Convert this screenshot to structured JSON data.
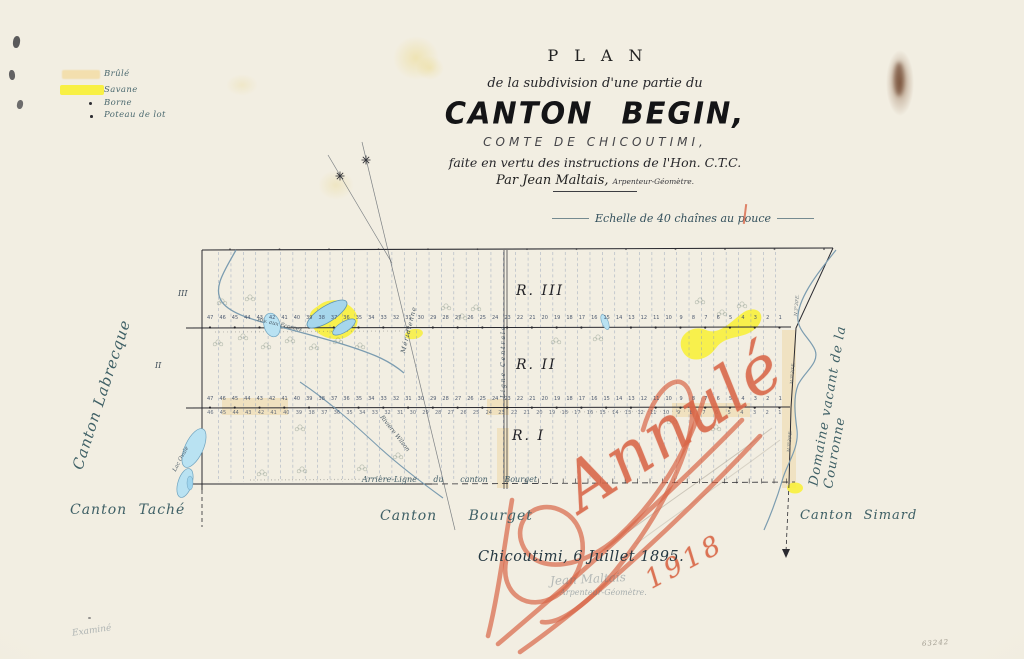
{
  "legend": {
    "items": [
      {
        "label": "Brûlé",
        "swatch": "tan"
      },
      {
        "label": "Savane",
        "swatch": "yellow"
      },
      {
        "label": "Borne",
        "swatch": "dot"
      },
      {
        "label": "Poteau de lot",
        "swatch": "dot"
      }
    ]
  },
  "title": {
    "kicker": "PLAN",
    "line1": "de la subdivision d'une partie du",
    "main": "CANTON BEGIN,",
    "subtitle": "COMTE DE CHICOUTIMI,",
    "line2": "faite en vertu des instructions de l'Hon. C.T.C.",
    "byline": "Par Jean Maltais,",
    "byline_role": "Arpenteur-Géomètre.",
    "scale": "Echelle de 40 chaînes au pouce"
  },
  "map": {
    "range_labels": [
      "R. III",
      "R. II",
      "R. I"
    ],
    "margin_numerals": [
      "III",
      "II"
    ],
    "central_line_label": "Ligne Centrale",
    "meridian_label": "Méridienne",
    "labels": {
      "river_left": "Riv. aux Écorces",
      "river_wilson": "Rivière Wilson",
      "lake_left": "Lac Ovale",
      "bearing": "N.3°30'E.",
      "arriere_ligne": "Arrière-Ligne  du canton  Bourget"
    },
    "lot_rows": [
      {
        "id": "lots-r3",
        "numbers": [
          47,
          46,
          45,
          44,
          43,
          42,
          41,
          40,
          39,
          38,
          37,
          36,
          35,
          34,
          33,
          32,
          31,
          30,
          29,
          28,
          27,
          26,
          25,
          24,
          23,
          22,
          21,
          20,
          19,
          18,
          17,
          16,
          15,
          14,
          13,
          12,
          11,
          10,
          9,
          8,
          7,
          6,
          5,
          4,
          3,
          2,
          1
        ]
      },
      {
        "id": "lots-r2",
        "numbers": [
          47,
          46,
          45,
          44,
          43,
          42,
          41,
          40,
          39,
          38,
          37,
          36,
          35,
          34,
          33,
          32,
          31,
          30,
          29,
          28,
          27,
          26,
          25,
          24,
          23,
          22,
          21,
          20,
          19,
          18,
          17,
          16,
          15,
          14,
          13,
          12,
          11,
          10,
          9,
          8,
          7,
          6,
          5,
          4,
          3,
          2,
          1
        ]
      },
      {
        "id": "lots-r1",
        "numbers": [
          46,
          45,
          44,
          43,
          42,
          41,
          40,
          39,
          38,
          37,
          36,
          35,
          34,
          33,
          32,
          31,
          30,
          29,
          28,
          27,
          26,
          25,
          24,
          23,
          22,
          21,
          20,
          19,
          18,
          17,
          16,
          15,
          14,
          13,
          12,
          11,
          10,
          9,
          8,
          7,
          6,
          5,
          4,
          3,
          2,
          1
        ]
      }
    ]
  },
  "surround": {
    "canton_left": "Canton Labrecque",
    "canton_bottom_left": "Canton Taché",
    "canton_bottom_mid": "Canton  Bourget",
    "canton_bottom_right": "Canton Simard",
    "domaine_right": "Domaine vacant de la Couronne"
  },
  "red_annotation": {
    "word": "Annulé",
    "year": "1918"
  },
  "footer": {
    "place_date": "Chicoutimi, 6 Juillet 1895.",
    "signature": "Jean Maltais",
    "signature_role": "Arpenteur-Géomètre.",
    "examined": "Examiné",
    "file_number": "63242"
  },
  "colors": {
    "accent_red": "#d86748",
    "savane_yellow": "#f8ef3c",
    "brule_tan": "#eed9a8",
    "water_blue": "#b9e2f2",
    "label_teal": "#3f6066",
    "ink": "#1c1c20"
  }
}
